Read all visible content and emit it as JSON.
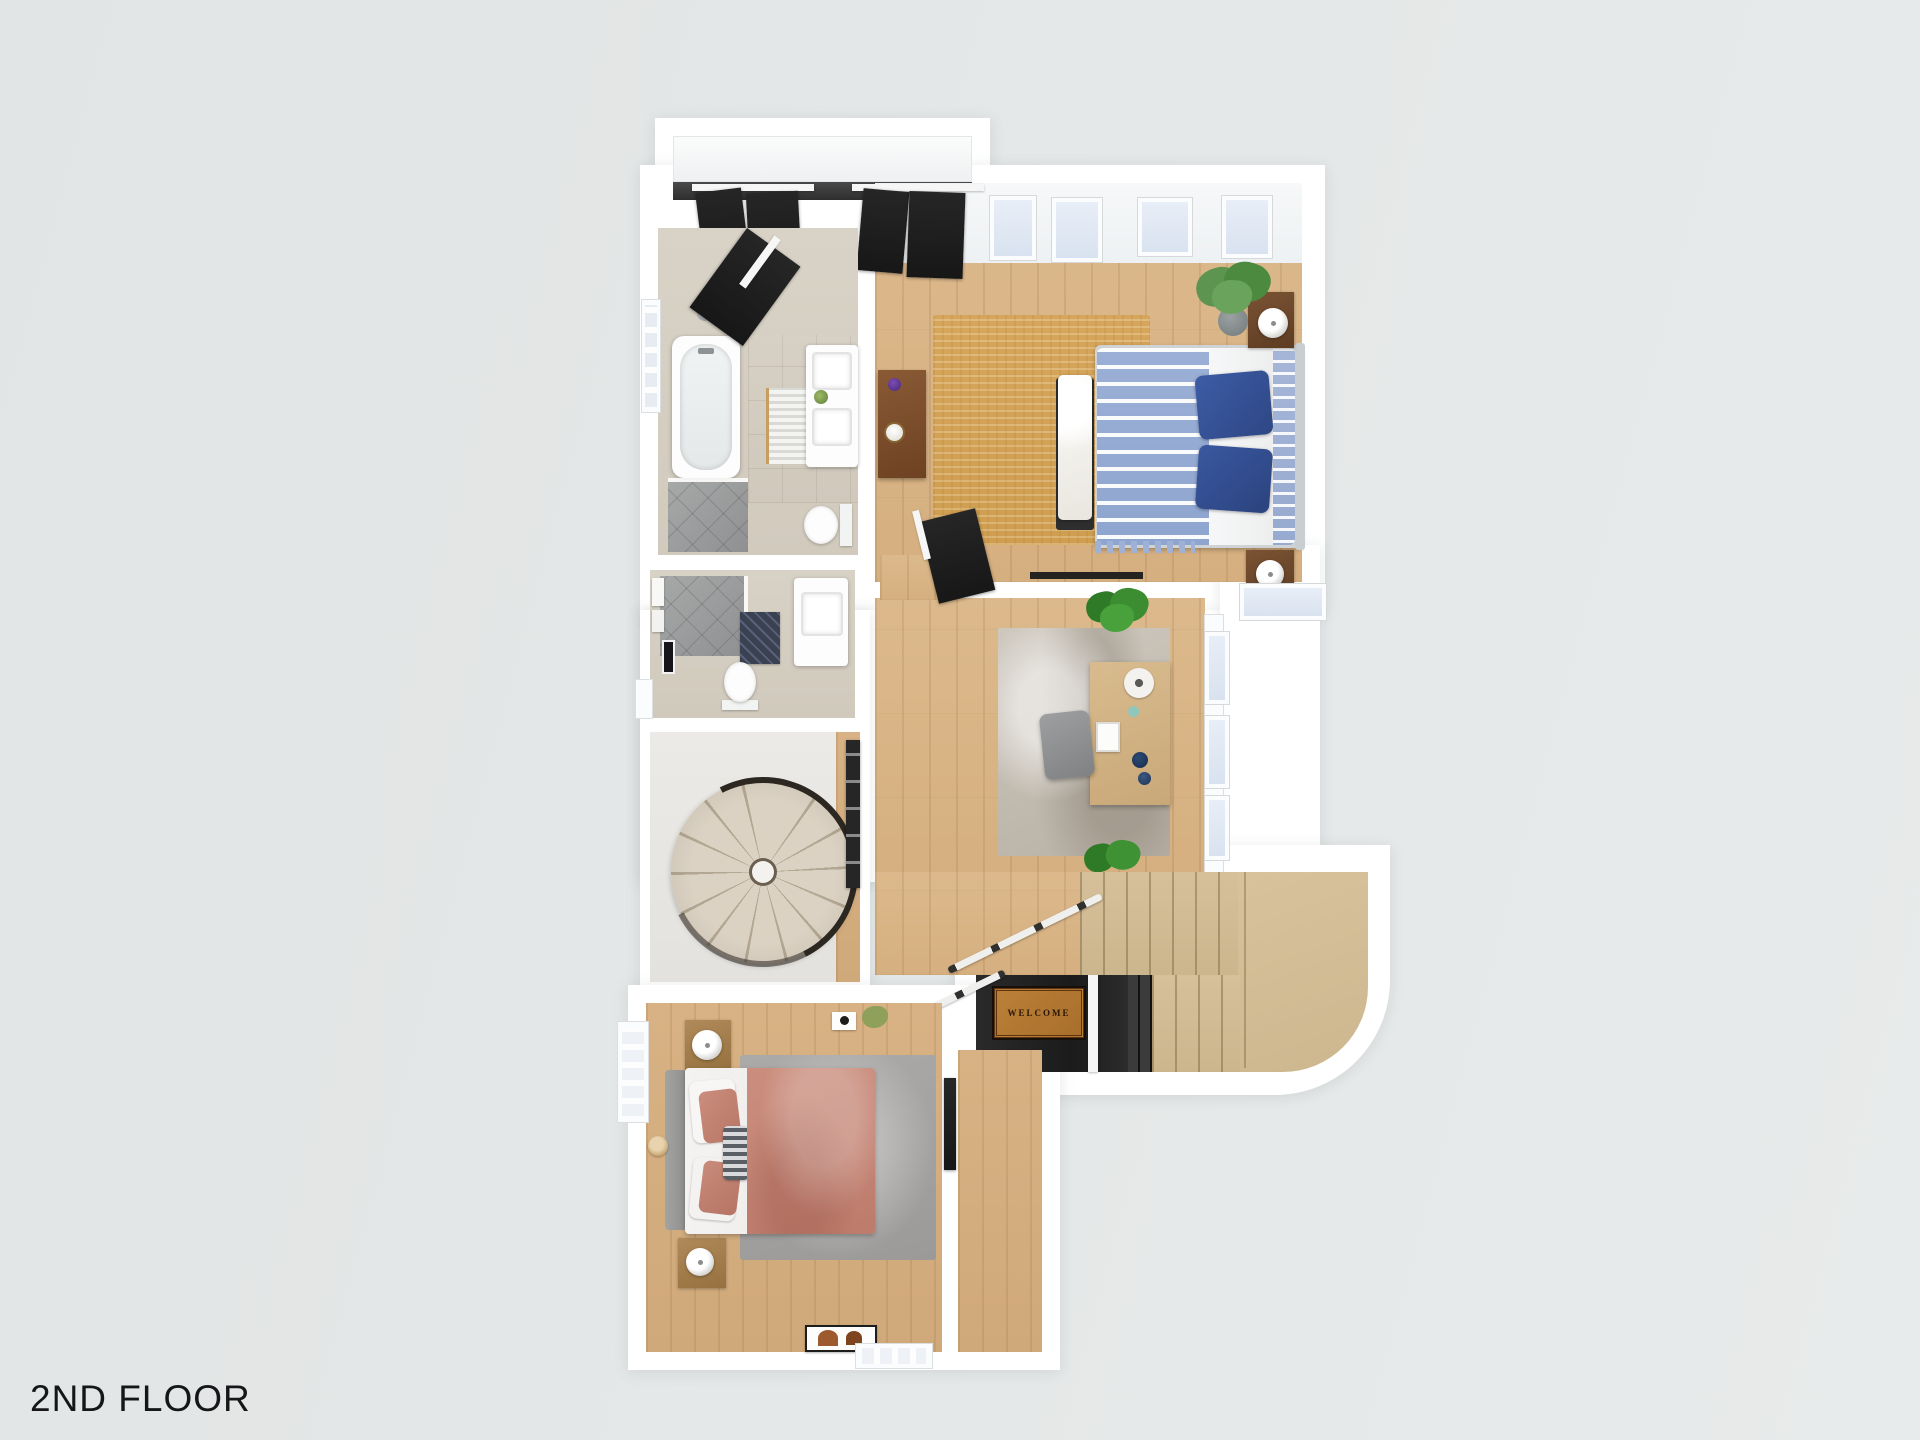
{
  "title": {
    "label": "2ND FLOOR"
  },
  "entry": {
    "welcome_mat_text": "WELCOME"
  },
  "palette": {
    "background": "#e5e8e8",
    "wall_white": "#ffffff",
    "wood_floor": "#d9b586",
    "jute_rug": "#d2a257",
    "office_rug": "#c6c0b6",
    "gray_rug": "#a8a8a6",
    "duvet_blue": "#96abd2",
    "pillow_navy": "#35549b",
    "bed_salmon": "#c8897b",
    "stair_carpet_tan": "#d3bd96",
    "door_black": "#1f1f1f",
    "welcome_mat_brown": "#b97f36",
    "plant_green": "#4c8a3f",
    "tile_greige": "#d6cfc3",
    "shower_gray": "#9aa0a0"
  },
  "furniture_icons": [
    "double-bed-blue",
    "double-bed-salmon",
    "bench",
    "nightstand",
    "table-lamp",
    "potted-plant",
    "dresser",
    "bathtub",
    "shower",
    "shower-head",
    "double-vanity",
    "sink",
    "toilet",
    "bath-mat",
    "spiral-staircase",
    "stair-railing",
    "desk",
    "office-chair",
    "area-rug",
    "staircase",
    "welcome-mat",
    "window",
    "skylight",
    "closet-door",
    "artwork",
    "towel",
    "round-basket",
    "desk-fan"
  ]
}
